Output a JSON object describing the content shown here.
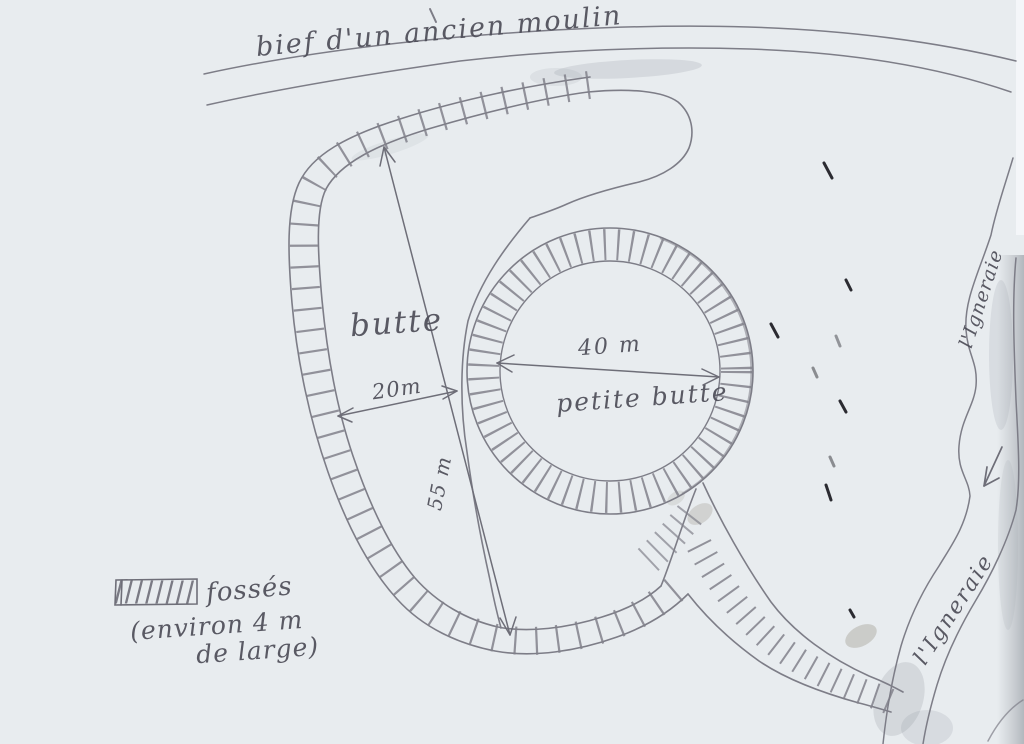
{
  "labels": {
    "millrace": "bief d'un ancien moulin",
    "mound": "butte",
    "small_mound": "petite butte",
    "river_upper": "l'Igneraie",
    "river_lower": "l'Igneraie"
  },
  "measurements": {
    "neck_width": "20m",
    "small_mound_diameter": "40 m",
    "mound_length": "55 m"
  },
  "legend": {
    "swatch": "hatched-rectangle",
    "title": "fossés",
    "note_line1": "(environ 4 m",
    "note_line2": "de large)"
  },
  "colors": {
    "paper": "#e8ecef",
    "pencil": "#7d7d87",
    "ink": "#2b2b31"
  }
}
